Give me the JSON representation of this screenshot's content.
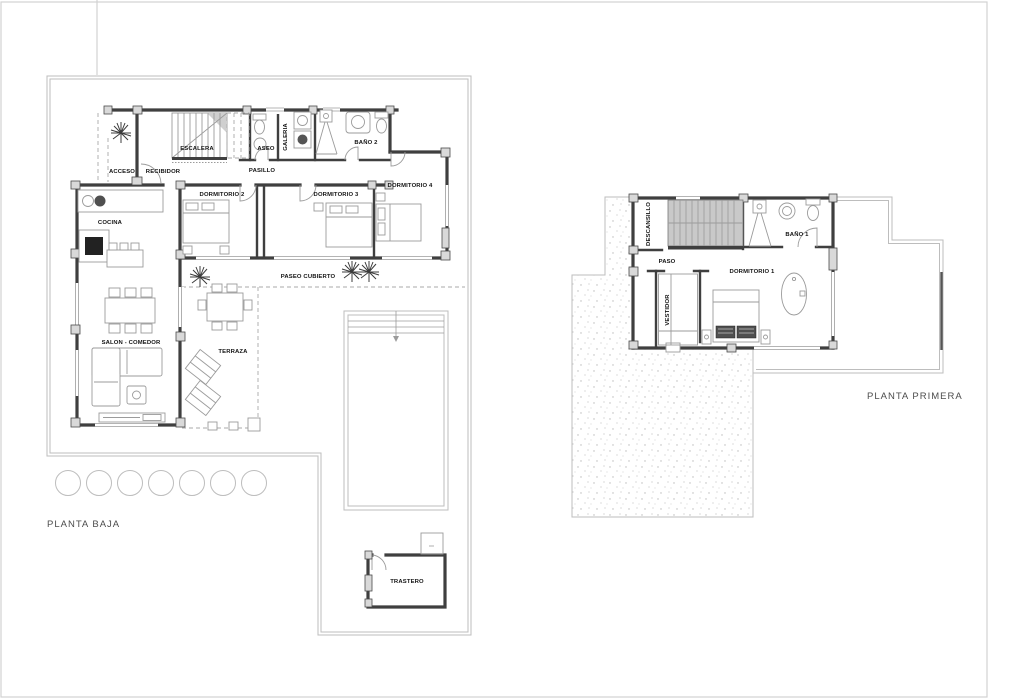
{
  "sheet": {
    "plans": {
      "planta_baja": {
        "title": "PLANTA BAJA",
        "rooms": {
          "acceso": "ACCESO",
          "recibidor": "RECIBIDOR",
          "escalera": "ESCALERA",
          "aseo": "ASEO",
          "galeria": "GALERIA",
          "bano2": "BAÑO 2",
          "pasillo": "PASILLO",
          "dormitorio2": "DORMITORIO 2",
          "dormitorio3": "DORMITORIO 3",
          "dormitorio4": "DORMITORIO 4",
          "cocina": "COCINA",
          "salon_comedor": "SALON - COMEDOR",
          "paseo_cubierto": "PASEO CUBIERTO",
          "terraza": "TERRAZA",
          "trastero": "TRASTERO"
        }
      },
      "planta_primera": {
        "title": "PLANTA PRIMERA",
        "rooms": {
          "descansillo": "DESCANSILLO",
          "paso": "PASO",
          "vestidor": "VESTIDOR",
          "dormitorio1": "DORMITORIO 1",
          "bano1": "BAÑO 1"
        }
      }
    },
    "colors": {
      "background": "#ffffff",
      "wall": "#3f3f3f",
      "wall_fill": "#d9d9d9",
      "boundary_line": "#bdbdbd",
      "furniture_line": "#9b9b9b",
      "stair_fill": "#c9c9c9",
      "label": "#141414",
      "title": "#4c4c4c"
    }
  }
}
